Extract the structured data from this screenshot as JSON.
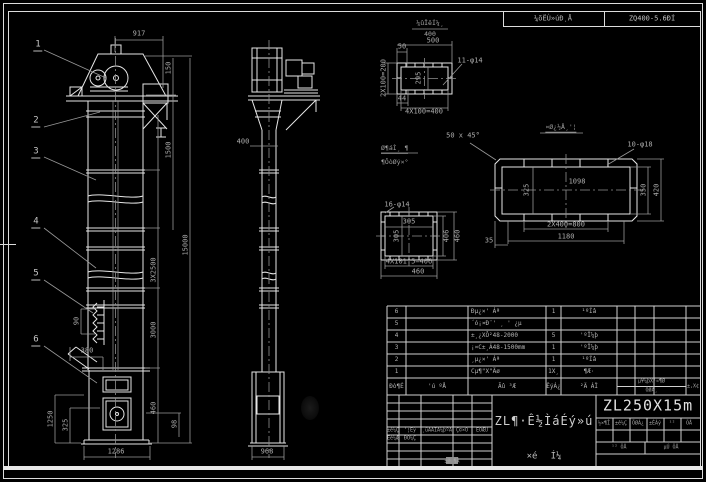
{
  "canvas": {
    "width": 706,
    "height": 482,
    "background": "#000000",
    "line_color": "#e6e6e6",
    "dim_color": "#989898"
  },
  "top_strip": {
    "note_numerator": "¼ûÏêÍ¼¸",
    "note_denominator": "400",
    "reducer_label": "¼õËÙ»úÐͺÅ",
    "reducer_model": "ZQ400-5.6ÐÍ"
  },
  "balloons": [
    {
      "n": "1",
      "x": 38,
      "y": 46
    },
    {
      "n": "2",
      "x": 36,
      "y": 122
    },
    {
      "n": "3",
      "x": 36,
      "y": 153
    },
    {
      "n": "4",
      "x": 36,
      "y": 223
    },
    {
      "n": "5",
      "x": 36,
      "y": 275
    },
    {
      "n": "6",
      "x": 36,
      "y": 341
    }
  ],
  "annotations": [
    {
      "t": "917",
      "x": 139,
      "y": 34
    },
    {
      "t": "150",
      "x": 169,
      "y": 68,
      "r": 1
    },
    {
      "t": "1500",
      "x": 169,
      "y": 150,
      "r": 1
    },
    {
      "t": "15000",
      "x": 186,
      "y": 245,
      "r": 1
    },
    {
      "t": "3X2500",
      "x": 154,
      "y": 270,
      "r": 1
    },
    {
      "t": "3000",
      "x": 154,
      "y": 330,
      "r": 1
    },
    {
      "t": "90",
      "x": 77,
      "y": 321,
      "r": 1
    },
    {
      "t": "380",
      "x": 87,
      "y": 351
    },
    {
      "t": "1250",
      "x": 51,
      "y": 419,
      "r": 1
    },
    {
      "t": "325",
      "x": 66,
      "y": 425,
      "r": 1
    },
    {
      "t": "1286",
      "x": 116,
      "y": 452
    },
    {
      "t": "460",
      "x": 154,
      "y": 408,
      "r": 1
    },
    {
      "t": "98",
      "x": 175,
      "y": 424,
      "r": 1
    },
    {
      "t": "400",
      "x": 243,
      "y": 142
    },
    {
      "t": "968",
      "x": 267,
      "y": 452
    },
    {
      "t": "500",
      "x": 433,
      "y": 41
    },
    {
      "t": "50",
      "x": 402,
      "y": 47
    },
    {
      "t": "11-φ14",
      "x": 470,
      "y": 61
    },
    {
      "t": "2X100=200",
      "x": 384,
      "y": 78,
      "r": 1
    },
    {
      "t": "295",
      "x": 419,
      "y": 78,
      "r": 1
    },
    {
      "t": "44",
      "x": 402,
      "y": 99
    },
    {
      "t": "4X100=400",
      "x": 424,
      "y": 112
    },
    {
      "t": "50 x 45°",
      "x": 463,
      "y": 136
    },
    {
      "t": "Ø¶áÌ¸ ¶",
      "x": 381,
      "y": 149,
      "a": 1,
      "u": 1,
      "s": "note"
    },
    {
      "t": "¶ÔòØý×°",
      "x": 381,
      "y": 162,
      "a": 1,
      "s": "note"
    },
    {
      "t": "16-φ14",
      "x": 397,
      "y": 205
    },
    {
      "t": "305",
      "x": 409,
      "y": 222
    },
    {
      "t": "305",
      "x": 397,
      "y": 236,
      "r": 1
    },
    {
      "t": "4X101.5=406",
      "x": 409,
      "y": 262
    },
    {
      "t": "460",
      "x": 418,
      "y": 272
    },
    {
      "t": "406",
      "x": 447,
      "y": 236,
      "r": 1
    },
    {
      "t": "460",
      "x": 458,
      "y": 236,
      "r": 1
    },
    {
      "t": "¤Ø¿½Å¸'¦",
      "x": 561,
      "y": 128,
      "u": 1,
      "s": "note"
    },
    {
      "t": "10-φ18",
      "x": 640,
      "y": 145
    },
    {
      "t": "1098",
      "x": 577,
      "y": 182
    },
    {
      "t": "325",
      "x": 527,
      "y": 190,
      "r": 1
    },
    {
      "t": "350",
      "x": 644,
      "y": 190,
      "r": 1
    },
    {
      "t": "420",
      "x": 657,
      "y": 190,
      "r": 1
    },
    {
      "t": "2X400=800",
      "x": 566,
      "y": 225
    },
    {
      "t": "1180",
      "x": 566,
      "y": 237
    },
    {
      "t": "35",
      "x": 489,
      "y": 241
    }
  ],
  "parts_table": {
    "col_x": [
      387,
      406,
      468,
      546,
      561,
      617,
      635,
      654,
      686,
      700
    ],
    "row_y": [
      306,
      318,
      330,
      342,
      354,
      366,
      378,
      395
    ],
    "rows": [
      {
        "cells": [
          {
            "c": 0,
            "t": "6"
          },
          {
            "c": 2,
            "t": "Ðµ¿×' Áª"
          },
          {
            "c": 3,
            "t": "1"
          },
          {
            "c": 4,
            "t": "¹ºÍâ"
          }
        ]
      },
      {
        "cells": [
          {
            "c": 0,
            "t": "5"
          },
          {
            "c": 2,
            "t": "´ó¡¤Ð¨' ¸ ' ¿µ"
          }
        ]
      },
      {
        "cells": [
          {
            "c": 0,
            "t": "4"
          },
          {
            "c": 2,
            "t": "±¸¿XÔ²48-2000"
          },
          {
            "c": 3,
            "t": "5"
          },
          {
            "c": 4,
            "t": "'ºÏ¼þ"
          }
        ]
      },
      {
        "cells": [
          {
            "c": 0,
            "t": "3"
          },
          {
            "c": 2,
            "t": "¡¤C±¸Á48-1500mm"
          },
          {
            "c": 3,
            "t": "1"
          },
          {
            "c": 4,
            "t": "'ºÏ¼þ"
          }
        ]
      },
      {
        "cells": [
          {
            "c": 0,
            "t": "2"
          },
          {
            "c": 2,
            "t": "¸µ¿×' Áª"
          },
          {
            "c": 3,
            "t": "1"
          },
          {
            "c": 4,
            "t": "¹ºÍâ"
          }
        ]
      },
      {
        "cells": [
          {
            "c": 0,
            "t": "1"
          },
          {
            "c": 2,
            "t": "Cµ¶\"X\"Äø"
          },
          {
            "c": 3,
            "t": "1X¸"
          },
          {
            "c": 4,
            "t": "¶Æ·"
          }
        ]
      }
    ],
    "header": {
      "c0": "Ðò¶É",
      "c1": "'ú ºÅ",
      "c2": "Ãû ³Æ",
      "c3": "ÊýÁ¿",
      "c4": "²Ä ÁÏ",
      "weight_top": "µ¥¼þX¹«¶Ø",
      "weight_bottom": "ÖØÁ¸",
      "c8": "±,X¢"
    }
  },
  "title_block": {
    "drawing_no": "ZL250X15m",
    "title": "ZL¶·Ê½ÌáÉý»ú",
    "subtitle_left": "×é",
    "subtitle_right": "Í¼",
    "small_labels": [
      {
        "t": "±ê¼Ç",
        "x": 393,
        "y": 431
      },
      {
        "t": "'¦Êý",
        "x": 410,
        "y": 431
      },
      {
        "t": "¸üÄÄÎÄ¼þºÅ",
        "x": 437,
        "y": 431
      },
      {
        "t": "Ç©×Ö",
        "x": 462,
        "y": 431
      },
      {
        "t": "ÈÕÆÚ",
        "x": 482,
        "y": 431
      },
      {
        "t": "Éè¼Æ",
        "x": 393,
        "y": 439
      },
      {
        "t": "ÐÕ¼Ç",
        "x": 410,
        "y": 439
      },
      {
        "t": "±Ø ¶Å",
        "x": 452,
        "y": 462
      },
      {
        "t": "½×¶Î",
        "x": 604,
        "y": 424
      },
      {
        "t": "±ê¼Ç",
        "x": 621,
        "y": 424
      },
      {
        "t": "ÖØÁ¿",
        "x": 638,
        "y": 424
      },
      {
        "t": "±ÈÀý",
        "x": 655,
        "y": 424
      },
      {
        "t": "¹²",
        "x": 672,
        "y": 424
      },
      {
        "t": "ÕÅ",
        "x": 689,
        "y": 424
      },
      {
        "t": "¹² ÕÅ",
        "x": 619,
        "y": 448
      },
      {
        "t": "µÚ ÕÅ",
        "x": 671,
        "y": 448
      }
    ]
  }
}
